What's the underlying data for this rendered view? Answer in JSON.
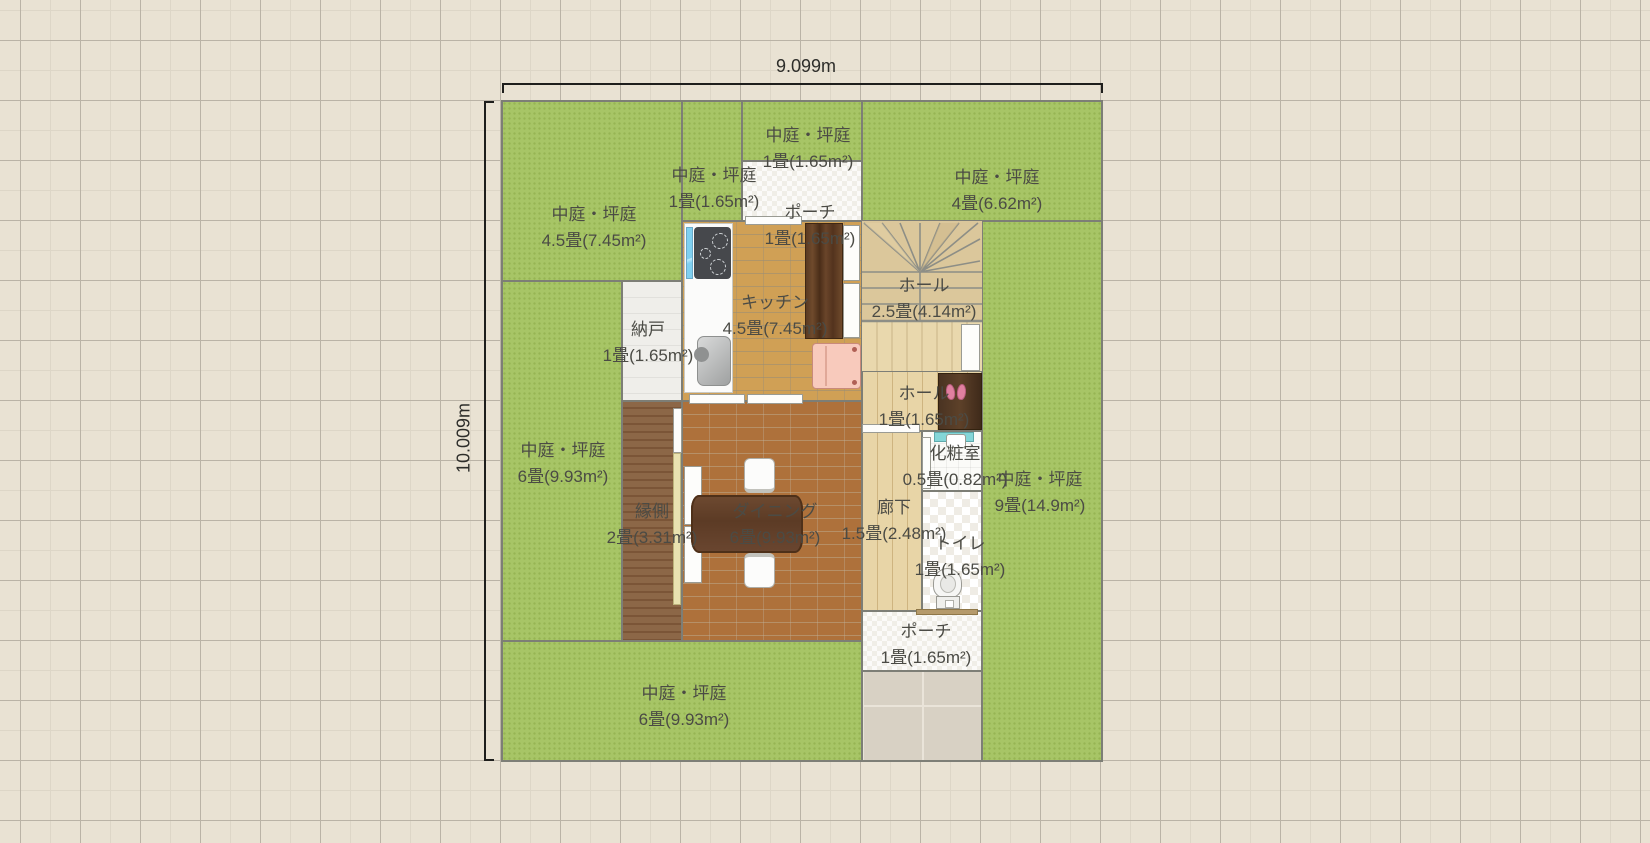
{
  "canvas": {
    "background": "#e9e2d3",
    "grid_major": "#bab3a6",
    "grid_minor": "#ddd6c7"
  },
  "dimensions": {
    "width_label": "9.099m",
    "height_label": "10.009m"
  },
  "rooms": [
    {
      "id": "courtyard-top-left",
      "name": "中庭・坪庭",
      "area": "4.5畳(7.45m²)"
    },
    {
      "id": "courtyard-top-mid",
      "name": "中庭・坪庭",
      "area": "1畳(1.65m²)"
    },
    {
      "id": "courtyard-above-porch",
      "name": "中庭・坪庭",
      "area": "1畳(1.65m²)"
    },
    {
      "id": "courtyard-top-right",
      "name": "中庭・坪庭",
      "area": "4畳(6.62m²)"
    },
    {
      "id": "porch-top",
      "name": "ポーチ",
      "area": "1畳(1.65m²)"
    },
    {
      "id": "kitchen",
      "name": "キッチン",
      "area": "4.5畳(7.45m²)"
    },
    {
      "id": "hall-stairs",
      "name": "ホール",
      "area": "2.5畳(4.14m²)"
    },
    {
      "id": "storeroom",
      "name": "納戸",
      "area": "1畳(1.65m²)"
    },
    {
      "id": "courtyard-left",
      "name": "中庭・坪庭",
      "area": "6畳(9.93m²)"
    },
    {
      "id": "hall-entry",
      "name": "ホール",
      "area": "1畳(1.65m²)"
    },
    {
      "id": "powder-room",
      "name": "化粧室",
      "area": "0.5畳(0.82m²)"
    },
    {
      "id": "courtyard-right",
      "name": "中庭・坪庭",
      "area": "9畳(14.9m²)"
    },
    {
      "id": "engawa",
      "name": "縁側",
      "area": "2畳(3.31m²)"
    },
    {
      "id": "dining",
      "name": "ダイニング",
      "area": "6畳(9.93m²)"
    },
    {
      "id": "corridor",
      "name": "廊下",
      "area": "1.5畳(2.48m²)"
    },
    {
      "id": "toilet",
      "name": "トイレ",
      "area": "1畳(1.65m²)"
    },
    {
      "id": "porch-bottom",
      "name": "ポーチ",
      "area": "1畳(1.65m²)"
    },
    {
      "id": "courtyard-bottom",
      "name": "中庭・坪庭",
      "area": "6畳(9.93m²)"
    }
  ],
  "fixtures": {
    "stove-icon": "dark rounded rect with 3 burner rings",
    "kitchen-sink-icon": "gray rounded basin with faucet",
    "window-icon": "cyan strip",
    "cupboard-icon": "dark wood grain rect",
    "refrigerator-icon": "pink rounded rect",
    "dining-table-icon": "dark brown slab",
    "chair-icon": "white rounded seat",
    "stairs-icon": "winder stair fan with treads",
    "shoe-cabinet-icon": "dark brown cabinet",
    "slippers-icon": "two pink ovals",
    "washbasin-icon": "teal counter with white basin",
    "toilet-icon": "white bowl and tank",
    "sliding-door-icon": "white strip panel",
    "door-sill-icon": "tan threshold strip"
  },
  "colors": {
    "garden_green": "#a7c566",
    "wall_gray": "#7d7e76",
    "kitchen_floor": "#d0a055",
    "dining_floor": "#ae713b",
    "engawa_floor": "#8c6747",
    "hall_floor": "#e8d5a7",
    "path_tile": "#d8d1c4",
    "accent_pink": "#f7c9ba",
    "accent_teal": "#84d6d8",
    "label_text": "#4b4b45"
  }
}
